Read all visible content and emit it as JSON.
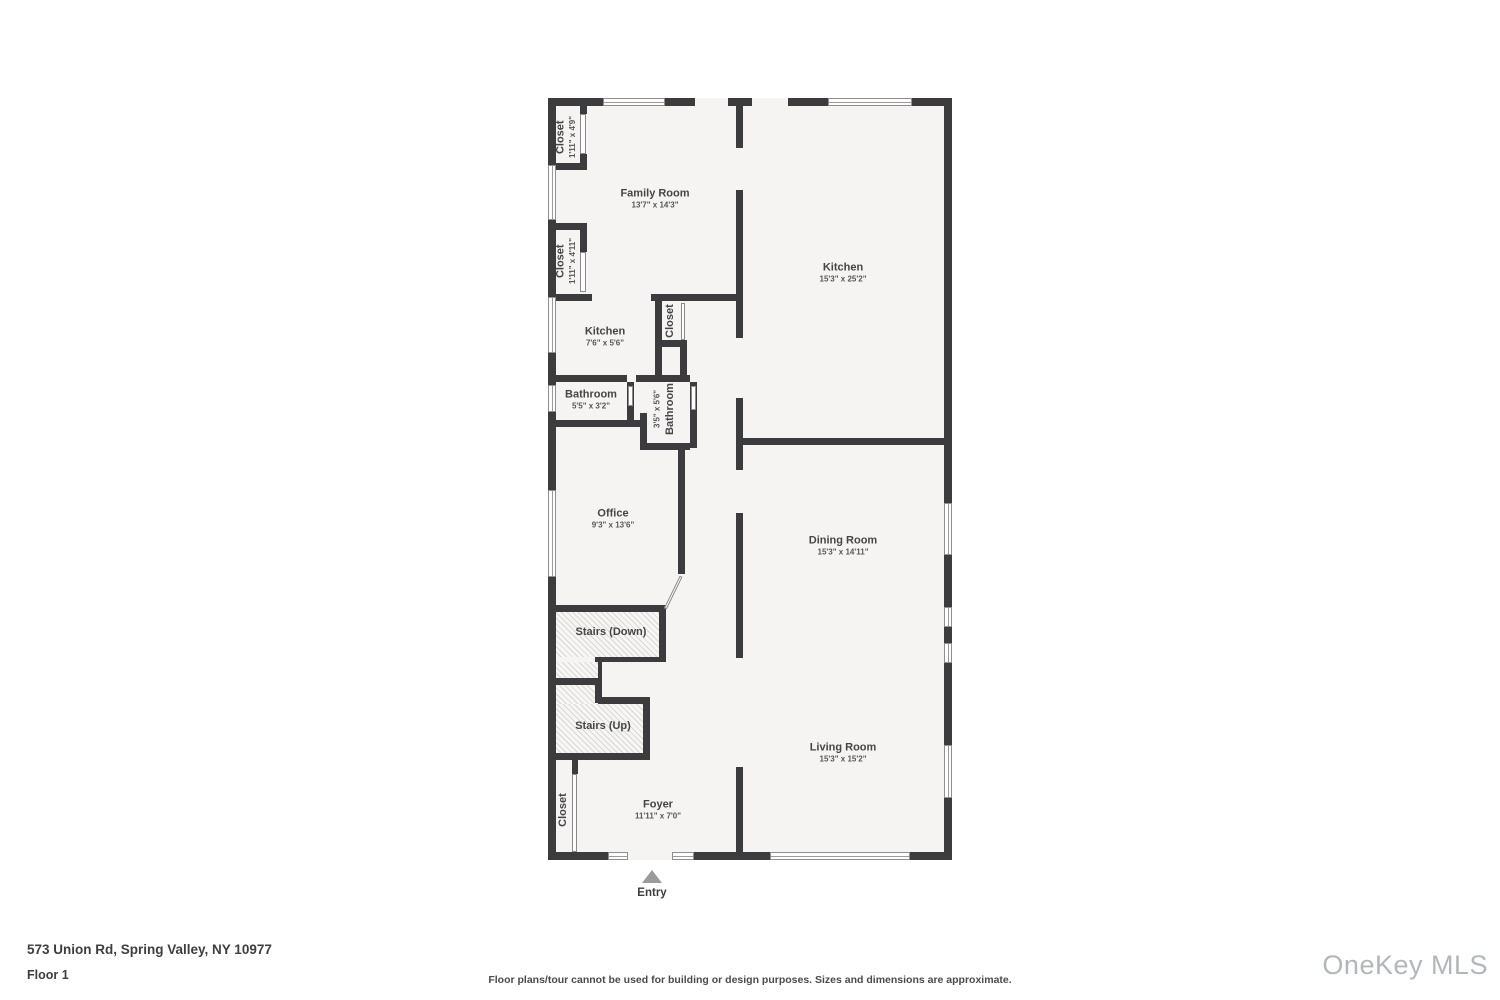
{
  "floorplan": {
    "wall_color": "#3c3c3e",
    "room_fill": "#f5f4f2",
    "rooms": [
      {
        "id": "family-room",
        "label": "Family Room",
        "dims": "13'7\" x 14'3\"",
        "x": 107,
        "y": 101,
        "orient": "h"
      },
      {
        "id": "kitchen",
        "label": "Kitchen",
        "dims": "15'3\" x 25'2\"",
        "x": 295,
        "y": 175,
        "orient": "h"
      },
      {
        "id": "closet-top-left",
        "label": "Closet",
        "dims": "1'11\" x 4'9\"",
        "x": 18,
        "y": 39,
        "orient": "v"
      },
      {
        "id": "closet-mid-left",
        "label": "Closet",
        "dims": "1'11\" x 4'11\"",
        "x": 18,
        "y": 163,
        "orient": "v"
      },
      {
        "id": "kitchen-2",
        "label": "Kitchen",
        "dims": "7'6\" x 5'6\"",
        "x": 57,
        "y": 239,
        "orient": "h"
      },
      {
        "id": "closet-center",
        "label": "Closet",
        "dims": "",
        "x": 122,
        "y": 223,
        "orient": "v"
      },
      {
        "id": "bathroom-1",
        "label": "Bathroom",
        "dims": "5'5\" x 3'2\"",
        "x": 43,
        "y": 302,
        "orient": "h"
      },
      {
        "id": "bathroom-2",
        "label": "Bathroom",
        "dims": "3'5\" x 5'6\"",
        "x": 117,
        "y": 311,
        "orient": "v",
        "flip": true
      },
      {
        "id": "office",
        "label": "Office",
        "dims": "9'3\" x 13'6\"",
        "x": 65,
        "y": 421,
        "orient": "h"
      },
      {
        "id": "dining-room",
        "label": "Dining Room",
        "dims": "15'3\" x 14'11\"",
        "x": 295,
        "y": 448,
        "orient": "h"
      },
      {
        "id": "stairs-down",
        "label": "Stairs (Down)",
        "dims": "",
        "x": 63,
        "y": 534,
        "orient": "h"
      },
      {
        "id": "stairs-up",
        "label": "Stairs (Up)",
        "dims": "",
        "x": 55,
        "y": 628,
        "orient": "h"
      },
      {
        "id": "living-room",
        "label": "Living Room",
        "dims": "15'3\" x 15'2\"",
        "x": 295,
        "y": 655,
        "orient": "h"
      },
      {
        "id": "foyer",
        "label": "Foyer",
        "dims": "11'11\" x 7'0\"",
        "x": 110,
        "y": 712,
        "orient": "h"
      },
      {
        "id": "closet-bottom-left",
        "label": "Closet",
        "dims": "",
        "x": 15,
        "y": 712,
        "orient": "v"
      }
    ],
    "entry": {
      "label": "Entry"
    }
  },
  "footer": {
    "address": "573 Union Rd, Spring Valley, NY 10977",
    "floor": "Floor 1",
    "disclaimer": "Floor plans/tour cannot be used for building or design purposes. Sizes and dimensions are approximate.",
    "brand": "OneKey MLS"
  }
}
